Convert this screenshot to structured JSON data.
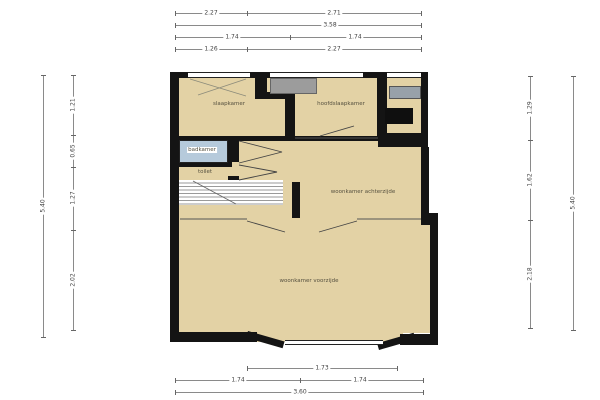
{
  "plan": {
    "type": "floorplan",
    "rooms": [
      {
        "label": "slaapkamer"
      },
      {
        "label": "hoofdslaapkamer"
      },
      {
        "label": "badkamer"
      },
      {
        "label": "toilet"
      },
      {
        "label": "woonkamer achterzijde"
      },
      {
        "label": "woonkamer voorzijde"
      }
    ],
    "features": [
      "stairs",
      "bay-window",
      "en-suite-doors",
      "shaft",
      "dormer-block"
    ]
  },
  "dimensions": {
    "top": {
      "row1": {
        "left": "2.27",
        "right": "2.71"
      },
      "row2": {
        "center": "3.58"
      },
      "row3": {
        "left": "1.74",
        "right": "1.74"
      },
      "row4": {
        "left": "1.26",
        "right": "2.27"
      }
    },
    "bottom": {
      "row1": {
        "center": "1.73"
      },
      "row2": {
        "left": "1.74",
        "right": "1.74"
      },
      "row3": {
        "center": "3.60"
      }
    },
    "left": {
      "outer_total": "5.40",
      "inner": [
        "1.21",
        "0.65",
        "1.27",
        "2.02"
      ]
    },
    "right": {
      "outer_total": "5.40",
      "inner": [
        "1.29",
        "1.62",
        "2.18"
      ]
    }
  },
  "colors": {
    "floor": "#e3d2a5",
    "wall": "#141414",
    "bathroom": "#b6cadb",
    "fixture_gray": "#9c9c9c",
    "shaft_black": "#0f0f0f",
    "dimension_line": "#8a8a8a"
  }
}
